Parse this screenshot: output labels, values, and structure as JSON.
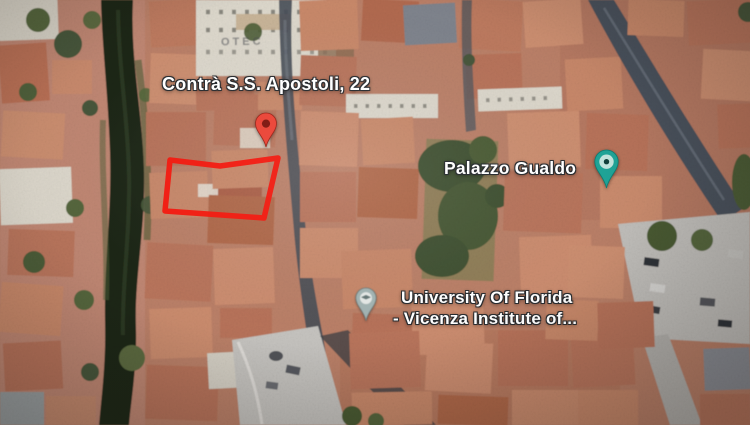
{
  "map": {
    "view_type": "satellite",
    "address_marker": {
      "label": "Contrà S.S. Apostoli, 22",
      "pin_color": "#EA4335"
    },
    "pois": [
      {
        "id": "palazzo-gualdo",
        "label": "Palazzo Gualdo",
        "pin_color": "#1fa396",
        "pin_icon": "landmark-eye"
      },
      {
        "id": "university-of-florida",
        "label_line1": "University Of Florida",
        "label_line2": "- Vicenza Institute of...",
        "pin_color": "#9fb6b8",
        "pin_icon": "school"
      }
    ],
    "annotation": {
      "shape": "rectangle",
      "color": "#f3180e"
    },
    "rooftop_text": "OTEC"
  }
}
